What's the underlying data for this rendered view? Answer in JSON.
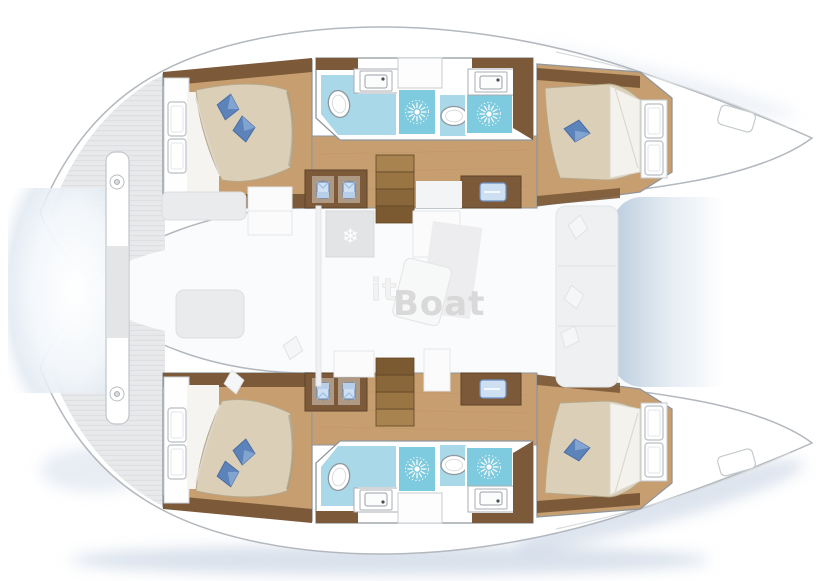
{
  "watermark": {
    "part1": "it",
    "part2": "Boat"
  },
  "plan": {
    "vessel_type": "catamaran-floor-plan",
    "double_cabins": 4,
    "bathrooms": 4,
    "showers": 4,
    "toilets": 4,
    "stairways": 2,
    "wardrobes": 2,
    "trampoline": 1
  },
  "icons": {
    "snowflake_glyph": "❄",
    "shower": "starburst-icon",
    "fridge": "snowflake-icon",
    "wardrobe": "hanging-shirt-icon",
    "toilet": "oval-toilet-icon",
    "sink": "basin-icon",
    "pillow": "diamond-pillow-icon"
  },
  "colors": {
    "wood-floor": "#c79e6f",
    "wood-dark": "#7c5a39",
    "wood-step": "#96714a",
    "mattress": "#dbcfb7",
    "pillow-dark": "#5d83bb",
    "pillow-light": "#85a7d4",
    "tile": "#a9d8e8",
    "tile-shower": "#7ecadf",
    "outline": "#8f969c",
    "deck-gray": "#e7e9eb",
    "deck-stripe": "#dddfe2",
    "ghost-fill": "#e9ebed",
    "ghost-stroke": "#dcdfe2",
    "shadow-blue": "#b3c4d9",
    "hull-stroke": "#b2b8be"
  }
}
